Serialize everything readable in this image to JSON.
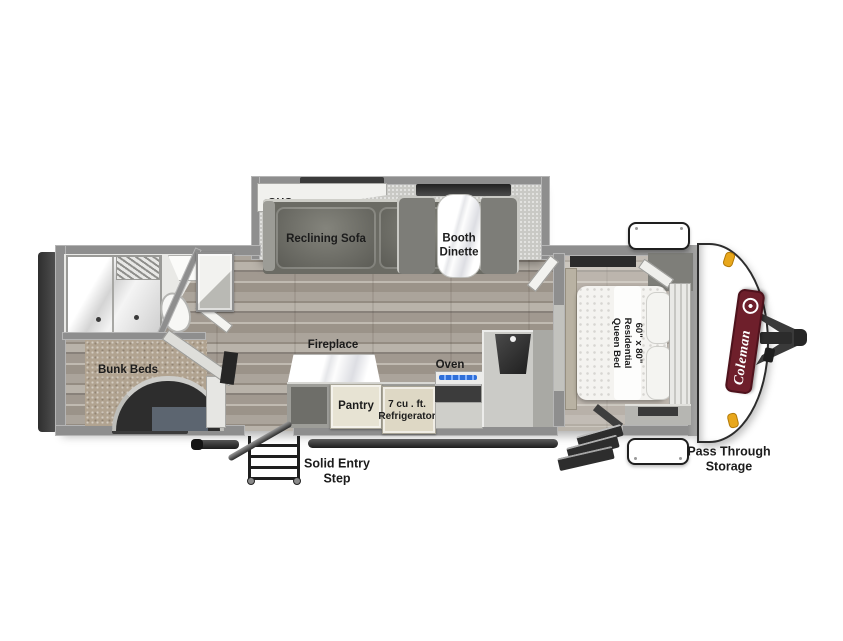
{
  "diagram": {
    "kind": "travel-trailer floor plan",
    "brand_logo": "Coleman"
  },
  "slideout": {
    "ohc_label": "OHC",
    "sofa_label": "Reclining Sofa",
    "dinette_label": "Booth\nDinette"
  },
  "bunk_room": {
    "label": "Bunk Beds"
  },
  "kitchen": {
    "fireplace_label": "Fireplace",
    "oven_label": "Oven",
    "pantry_label": "Pantry",
    "refrigerator_label": "7 cu . ft.\nRefrigerator"
  },
  "bedroom": {
    "bed_label": "60\" x 80\"\nResidential\nQueen Bed"
  },
  "exterior": {
    "entry_step_label": "Solid Entry\nStep",
    "storage_label": "Pass Through\nStorage"
  },
  "colors": {
    "brand_red": "#6e1f2b",
    "marker_amber": "#e8a71c",
    "wall_gray": "#8e8e8e",
    "flame_blue": "#2f6fd8"
  }
}
